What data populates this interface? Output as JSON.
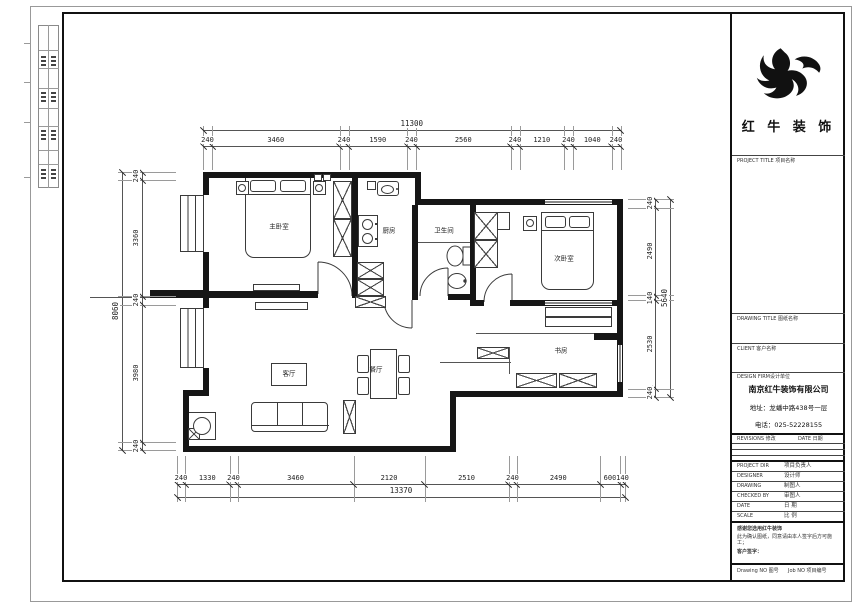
{
  "meta": {
    "colors": {
      "wall": "#161616",
      "dimension_line": "#555555",
      "text": "#222222"
    }
  },
  "title_block": {
    "logo_text": "红 牛 装 饰",
    "project_title_label": "PROJECT TITLE 项目名称",
    "drawing_title_label": "DRAWING TITLE 图纸名称",
    "client_label": "CLIENT 客户名称",
    "design_firm_label": "DESIGN FIRM设计单位",
    "firm_name": "南京红牛装饰有限公司",
    "firm_address": "地址：龙蟠中路438号一层",
    "firm_phone": "电话：025-52228155",
    "revisions_label": "REVISIONS 修改",
    "date_col_label": "DATE 日期",
    "personnel_rows": [
      {
        "en": "PROJECT DIR",
        "zh": "项目负责人"
      },
      {
        "en": "DESIGNER",
        "zh": "设计师"
      },
      {
        "en": "DRAWING",
        "zh": "制图人"
      },
      {
        "en": "CHECKED BY",
        "zh": "审图人"
      },
      {
        "en": "DATE",
        "zh": "日 期"
      },
      {
        "en": "SCALE",
        "zh": "比 例"
      }
    ],
    "note_line1": "感谢您选用红牛装饰",
    "note_line2": "此为确认图纸，同意请由本人签字后方可施工；",
    "note_line3": "客户签字：",
    "drawing_no_label": "Drawing NO 图号",
    "job_no_label": "Job NO 项目编号"
  },
  "plan": {
    "rooms": [
      "主卧室",
      "厨房",
      "卫生间",
      "次卧室",
      "客厅",
      "餐厅",
      "书房"
    ]
  },
  "dims": {
    "top": {
      "total": "11300",
      "segments": [
        "240",
        "3460",
        "240",
        "1590",
        "240",
        "2560",
        "240",
        "1210",
        "240",
        "1040",
        "240"
      ]
    },
    "bottom": {
      "total": "13370",
      "segments": [
        "240",
        "1330",
        "240",
        "3460",
        "2120",
        "2510",
        "240",
        "2490",
        "600",
        "140"
      ]
    },
    "left": {
      "total": "8060",
      "segments": [
        "240",
        "3360",
        "240",
        "3980",
        "240"
      ]
    },
    "right": {
      "total": "5640",
      "segments": [
        "240",
        "2490",
        "140",
        "2530",
        "240"
      ]
    }
  }
}
